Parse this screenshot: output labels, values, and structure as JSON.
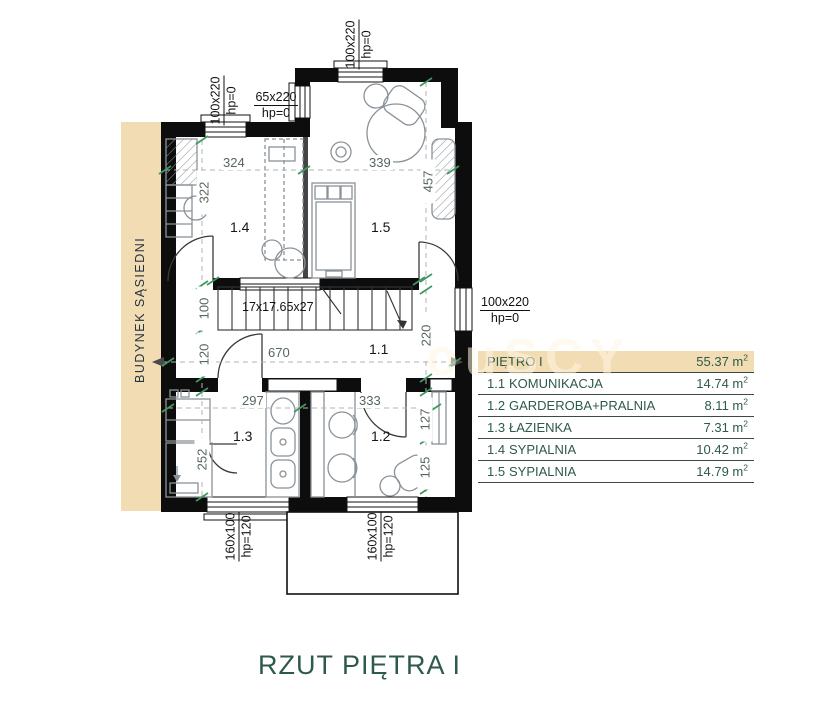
{
  "footer_title": "RZUT PIĘTRA I",
  "side_building_label": "BUDYNEK SĄSIEDNI",
  "watermark_fragment": "ouSCY",
  "stairs": {
    "label": "17x17.65x27"
  },
  "room_labels": {
    "r11": "1.1",
    "r12": "1.2",
    "r13": "1.3",
    "r14": "1.4",
    "r15": "1.5"
  },
  "dimensions": {
    "room14_width": "324",
    "room15_width": "339",
    "room14_depth": "322",
    "room15_depth": "457",
    "stairs_width": "100",
    "corridor_width": "120",
    "corridor_length": "670",
    "corridor_right": "220",
    "room13_width": "297",
    "room12_width": "333",
    "room12_right_upper": "127",
    "room12_right_lower": "125",
    "room13_depth": "252"
  },
  "openings": {
    "top_left_window": {
      "size": "100x220",
      "sill": "hp=0"
    },
    "top_window": {
      "size": "100x220",
      "sill": "hp=0"
    },
    "left_window_65": {
      "size": "65x220",
      "sill": "hp=0"
    },
    "right_window": {
      "size": "100x220",
      "sill": "hp=0"
    },
    "bottom_left_window": {
      "size": "160x100",
      "sill": "hp=120"
    },
    "bottom_right_window": {
      "size": "160x100",
      "sill": "hp=120"
    }
  },
  "legend": {
    "header_label": "PIĘTRO I",
    "header_area": "55.37",
    "unit": " m",
    "unit_sup": "2",
    "rows": [
      {
        "no": "1.1",
        "name": "KOMUNIKACJA",
        "area": "14.74"
      },
      {
        "no": "1.2",
        "name": "GARDEROBA+PRALNIA",
        "area": "8.11"
      },
      {
        "no": "1.3",
        "name": "ŁAZIENKA",
        "area": "7.31"
      },
      {
        "no": "1.4",
        "name": "SYPIALNIA",
        "area": "10.42"
      },
      {
        "no": "1.5",
        "name": "SYPIALNIA",
        "area": "14.79"
      }
    ]
  },
  "colors": {
    "accent_beige": "#f2dcb3",
    "brand_green": "#2d5a4a",
    "tick_green": "#3f9860"
  }
}
